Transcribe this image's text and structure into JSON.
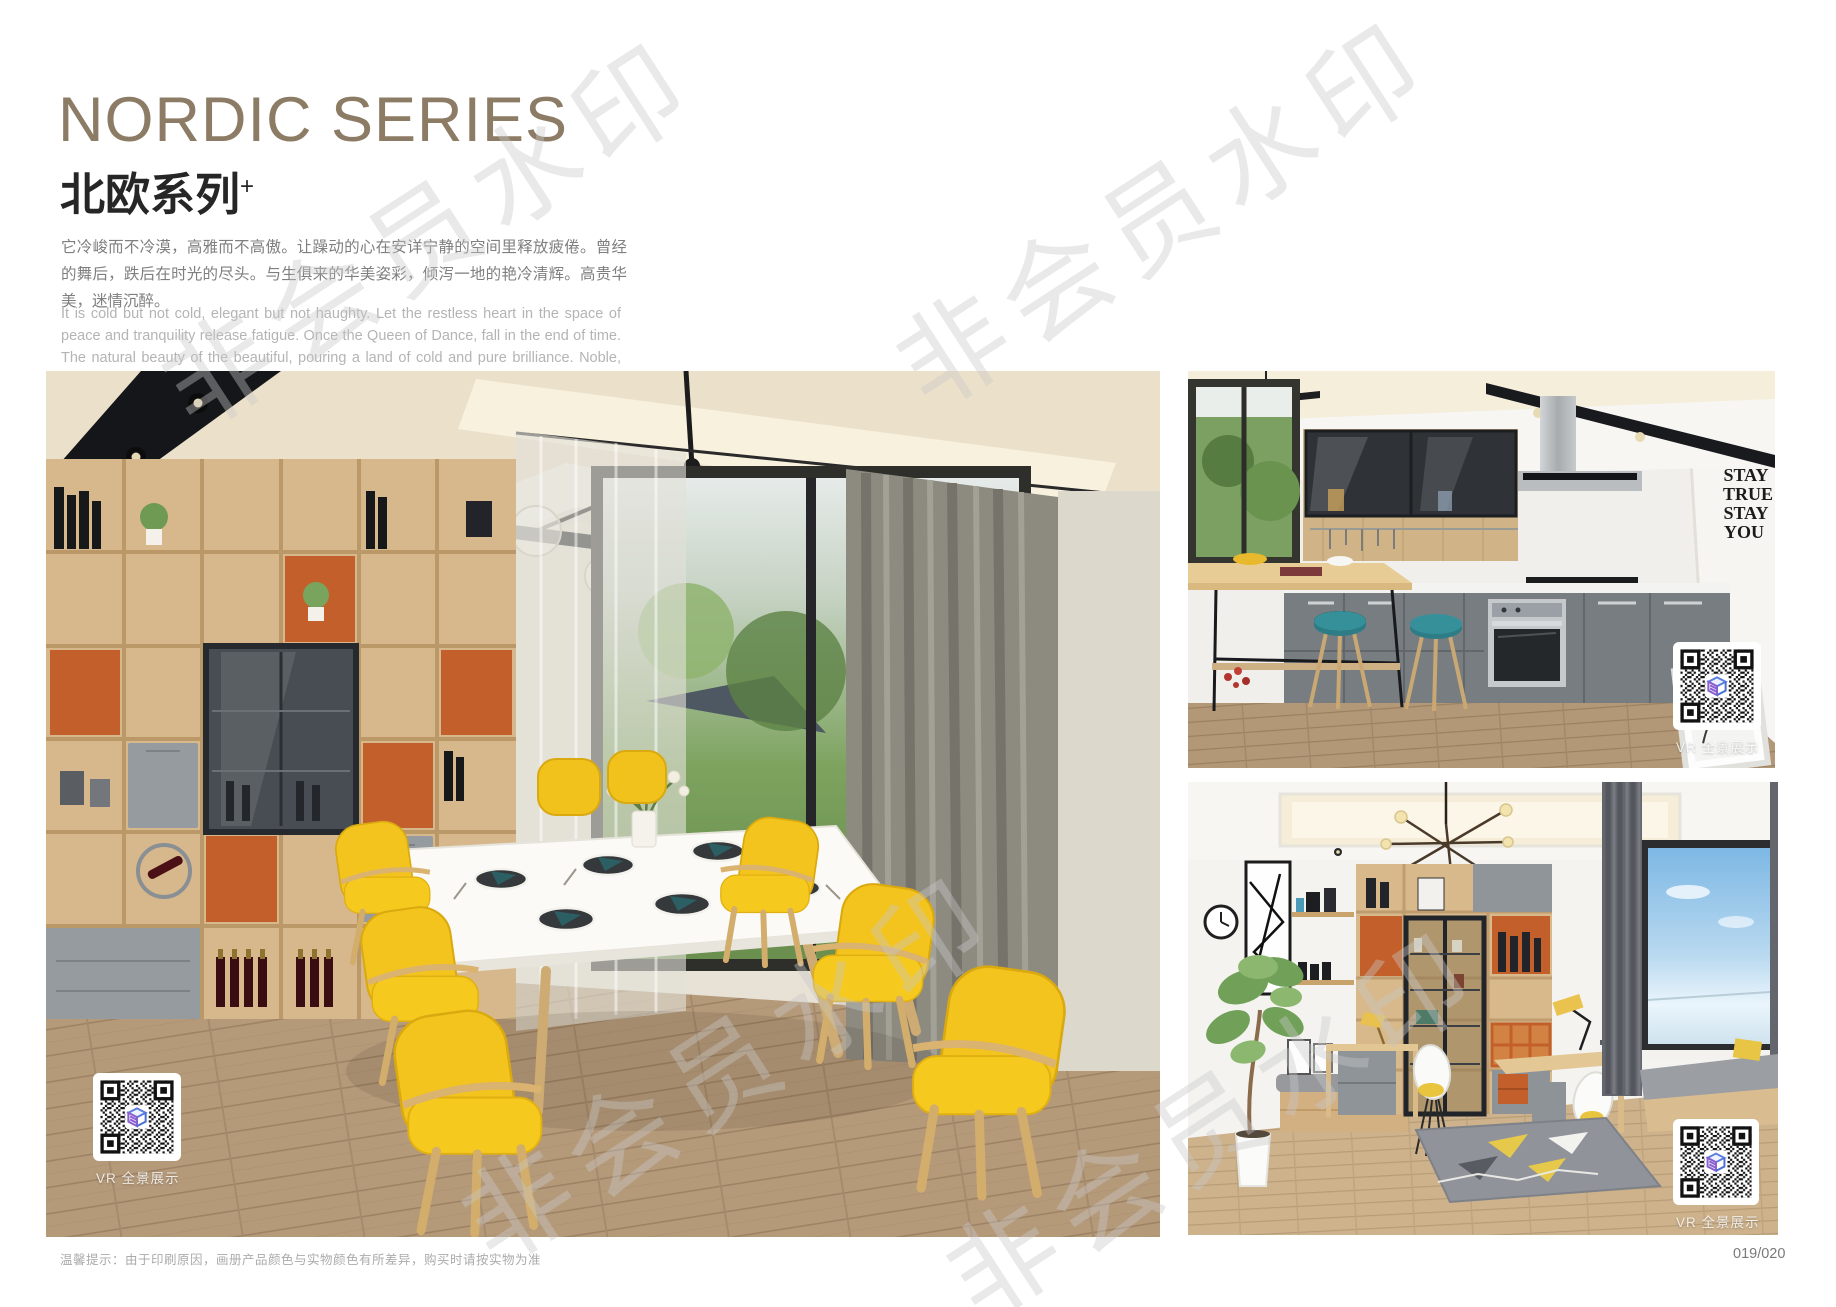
{
  "header": {
    "title_en": "NORDIC SERIES",
    "title_zh": "北欧系列",
    "title_superscript": "+",
    "paragraph_zh": "它冷峻而不冷漠，高雅而不高傲。让躁动的心在安详宁静的空间里释放疲倦。曾经的舞后，跌后在时光的尽头。与生俱来的华美姿彩，倾泻一地的艳冷清辉。高贵华美，迷情沉醉。",
    "paragraph_en": "It is cold but not cold, elegant but not haughty. Let the restless heart in the space of peace and tranquility release fatigue. Once the Queen of Dance, fall in the end of time. The natural beauty of the beautiful, pouring a land of cold and pure brilliance. Noble, beautiful, enchanted."
  },
  "photos": {
    "kitchen": {
      "wall_decor": [
        "STAY",
        "TRUE",
        "STAY",
        "YOU"
      ]
    }
  },
  "vr_badge": "VR 全景展示",
  "watermark": {
    "text": "非会员水印"
  },
  "footer": {
    "note": "温馨提示：由于印刷原因，画册产品颜色与实物颜色有所差异，购买时请按实物为准",
    "page_number": "019/020"
  },
  "colors": {
    "title_brown": "#8d7c65",
    "accent_orange": "#c25f2b",
    "accent_yellow": "#f4c41e",
    "accent_teal": "#2e7d86",
    "wood": "#d6b88c"
  }
}
